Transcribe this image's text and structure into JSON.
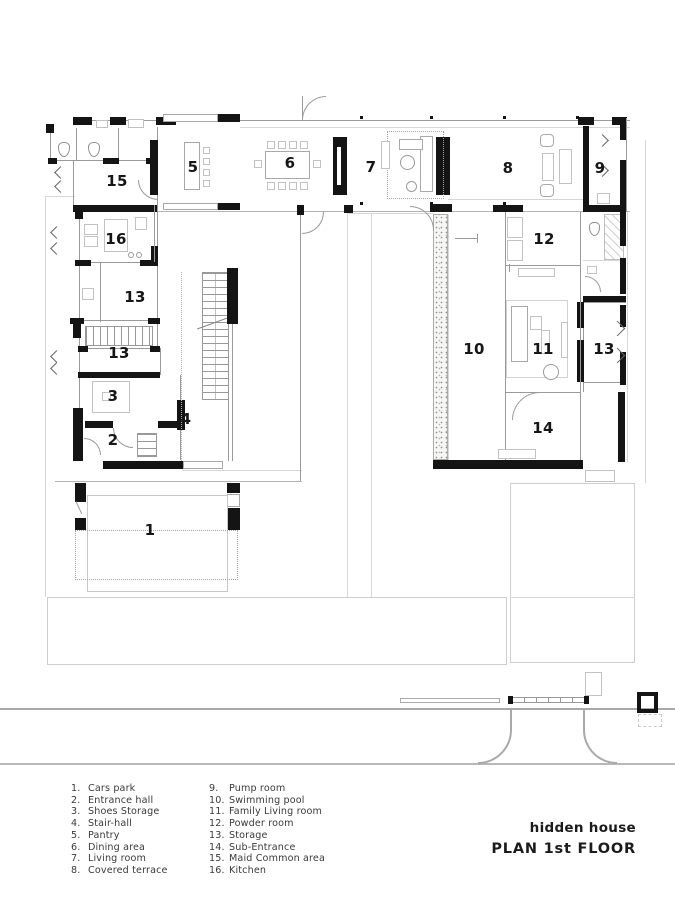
{
  "title": {
    "name": "hidden house",
    "plan": "PLAN 1st FLOOR"
  },
  "legend": {
    "col1": [
      {
        "num": "1.",
        "label": "Cars park"
      },
      {
        "num": "2.",
        "label": "Entrance hall"
      },
      {
        "num": "3.",
        "label": "Shoes Storage"
      },
      {
        "num": "4.",
        "label": "Stair-hall"
      },
      {
        "num": "5.",
        "label": "Pantry"
      },
      {
        "num": "6.",
        "label": "Dining area"
      },
      {
        "num": "7.",
        "label": "Living room"
      },
      {
        "num": "8.",
        "label": "Covered terrace"
      }
    ],
    "col2": [
      {
        "num": "9.",
        "label": "Pump room"
      },
      {
        "num": "10.",
        "label": "Swimming pool"
      },
      {
        "num": "11.",
        "label": "Family Living room"
      },
      {
        "num": "12.",
        "label": "Powder room"
      },
      {
        "num": "13.",
        "label": "Storage"
      },
      {
        "num": "14.",
        "label": "Sub-Entrance"
      },
      {
        "num": "15.",
        "label": "Maid Common area"
      },
      {
        "num": "16.",
        "label": "Kitchen"
      }
    ]
  },
  "plan_labels": {
    "r1": "1",
    "r2": "2",
    "r3": "3",
    "r4": "4",
    "r5": "5",
    "r6": "6",
    "r7": "7",
    "r8": "8",
    "r9": "9",
    "r10": "10",
    "r11": "11",
    "r12": "12",
    "r13a": "13",
    "r13b": "13",
    "r13c": "13",
    "r14": "14",
    "r15": "15",
    "r16": "16"
  },
  "colors": {
    "wall": "#141414",
    "line": "#9a9a9a",
    "faint": "#d6d6d6",
    "text": "#1b1b1b"
  }
}
